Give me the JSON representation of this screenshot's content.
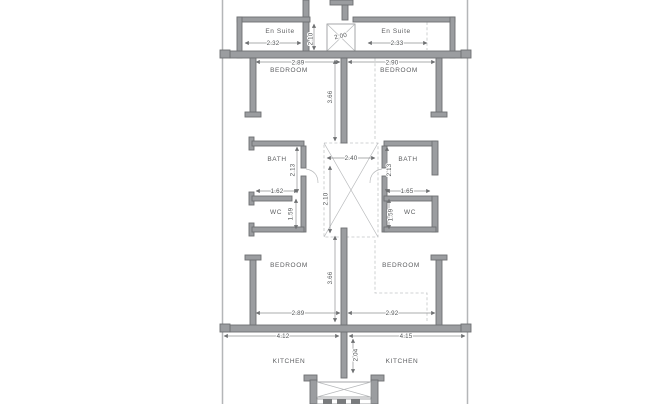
{
  "drawing": {
    "type": "architectural floor plan, two mirrored apartment units",
    "colors": {
      "background": "#ffffff",
      "wall": "#9b9da0",
      "wall_edge": "#6e7072",
      "dimension_line": "#8f9193",
      "text": "#5c5e60",
      "dashed": "#c3c5c7"
    }
  },
  "labels": {
    "en_suite_left": "En Suite",
    "en_suite_right": "En Suite",
    "bedroom_top_left": "BEDROOM",
    "bedroom_top_right": "BEDROOM",
    "bath_left": "BATH",
    "bath_right": "BATH",
    "wc_left": "WC",
    "wc_right": "WC",
    "bedroom_bottom_left": "BEDROOM",
    "bedroom_bottom_right": "BEDROOM",
    "kitchen_left": "KITCHEN",
    "kitchen_right": "KITCHEN"
  },
  "dims": {
    "en_suite_left_w": "2.32",
    "en_suite_right_w": "2.33",
    "top_shaft_w": "2.00",
    "top_shaft_h": "2.10",
    "bedroom_top_left_w": "2.89",
    "bedroom_top_right_w": "2.90",
    "bedroom_top_depth": "3.66",
    "bath_left_h": "2.13",
    "bath_right_h": "2.13",
    "wc_left_w": "1.62",
    "wc_right_w": "1.65",
    "wc_left_h": "1.59",
    "wc_right_h": "1.59",
    "shaft_w": "2.40",
    "shaft_h": "2.10",
    "bedroom_bottom_left_w": "2.89",
    "bedroom_bottom_right_w": "2.92",
    "bedroom_bottom_depth": "3.66",
    "kitchen_left_w": "4.12",
    "kitchen_right_w": "4.15",
    "kitchen_depth": "2.04"
  }
}
